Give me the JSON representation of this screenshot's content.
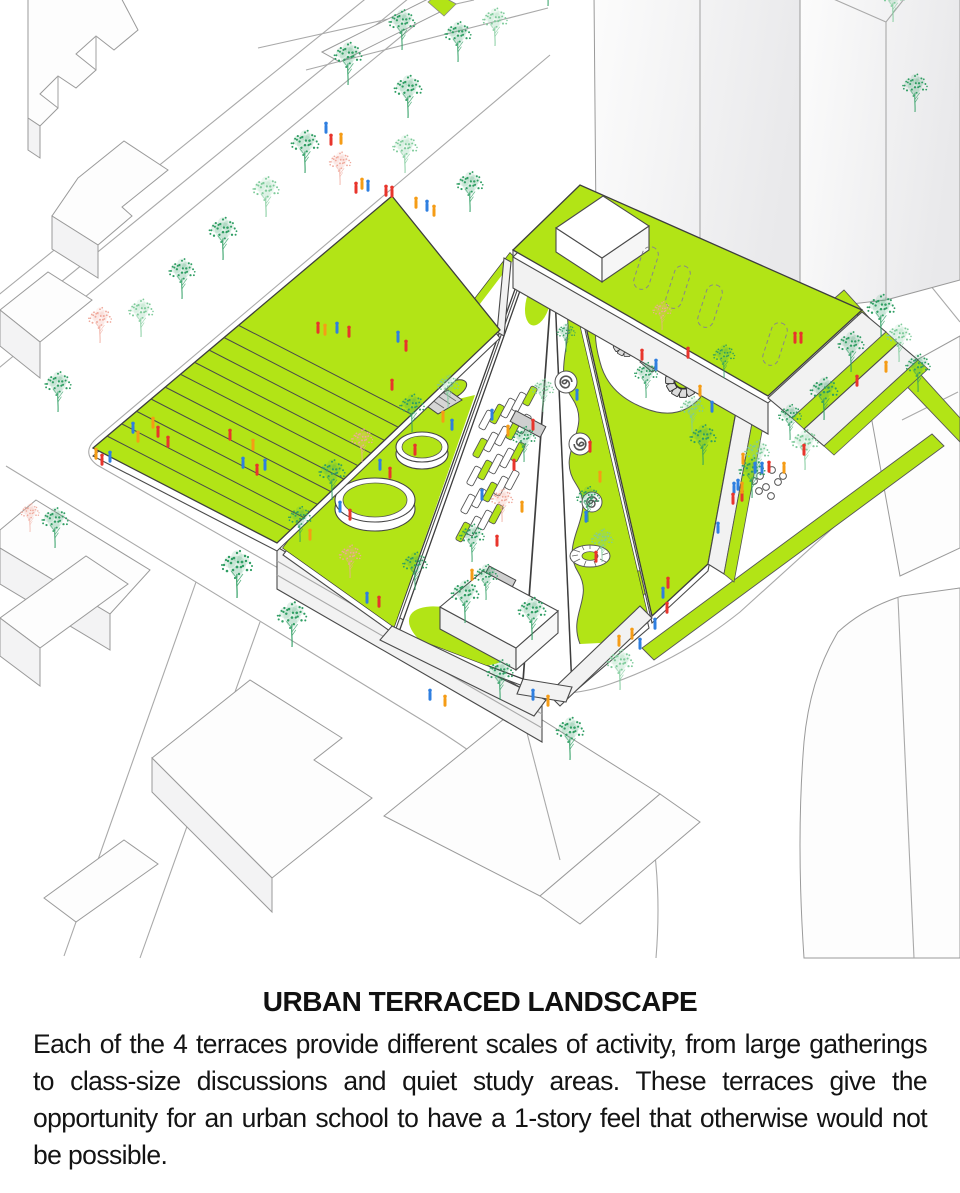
{
  "caption": {
    "title": "URBAN TERRACED LANDSCAPE",
    "body": "Each of the 4 terraces provide different scales of activity, from large gatherings to class-size discussions and quiet study areas. These terraces give the opportunity for an urban school to have a 1-story feel that otherwise would not be possible."
  },
  "palette": {
    "lawn_green": "#b2e416",
    "tree_green": "#2f9e63",
    "tree_light": "#7fcb9b",
    "tree_pink": "#efa89b",
    "person_red": "#e8352c",
    "person_blue": "#2f7fe0",
    "person_orange": "#f59c16",
    "wall_white": "#f2f2f2",
    "ramp_gray": "#d6d6d6",
    "school_outline": "#3d3d3d",
    "city_outline": "#9a9a9a",
    "street_line": "#a9a9a9",
    "text": "#141414"
  },
  "symbols": {
    "tree": "stippled-tree-icon",
    "person": "pedestrian-figure-icon",
    "flower": "circular-amphitheater-icon",
    "spiral": "spiral-path-icon",
    "skylight": "dashed-skylight-outline"
  },
  "scene": {
    "trees": [
      [
        348,
        85,
        0.9,
        "g"
      ],
      [
        305,
        173,
        0.9,
        "g"
      ],
      [
        266,
        217,
        0.85,
        "l"
      ],
      [
        223,
        260,
        0.9,
        "g"
      ],
      [
        182,
        299,
        0.85,
        "g"
      ],
      [
        141,
        337,
        0.8,
        "l"
      ],
      [
        100,
        343,
        0.75,
        "p"
      ],
      [
        58,
        412,
        0.85,
        "g"
      ],
      [
        340,
        185,
        0.7,
        "p"
      ],
      [
        402,
        50,
        0.85,
        "g"
      ],
      [
        458,
        62,
        0.85,
        "g"
      ],
      [
        408,
        118,
        0.9,
        "g"
      ],
      [
        405,
        173,
        0.8,
        "l"
      ],
      [
        470,
        212,
        0.85,
        "g"
      ],
      [
        495,
        46,
        0.8,
        "l"
      ],
      [
        548,
        6,
        0.85,
        "g"
      ],
      [
        893,
        22,
        0.8,
        "l"
      ],
      [
        915,
        112,
        0.8,
        "g"
      ],
      [
        881,
        337,
        0.9,
        "g"
      ],
      [
        899,
        362,
        0.8,
        "l"
      ],
      [
        851,
        372,
        0.85,
        "g"
      ],
      [
        824,
        420,
        0.9,
        "g"
      ],
      [
        805,
        470,
        0.85,
        "l"
      ],
      [
        918,
        392,
        0.8,
        "g"
      ],
      [
        703,
        465,
        0.85,
        "g"
      ],
      [
        757,
        478,
        0.8,
        "l"
      ],
      [
        790,
        440,
        0.75,
        "g"
      ],
      [
        752,
        498,
        0.85,
        "g"
      ],
      [
        570,
        760,
        0.9,
        "g"
      ],
      [
        532,
        640,
        0.9,
        "g"
      ],
      [
        620,
        690,
        0.85,
        "l"
      ],
      [
        237,
        598,
        1,
        "g"
      ],
      [
        292,
        647,
        0.95,
        "g"
      ],
      [
        350,
        578,
        0.7,
        "p"
      ],
      [
        465,
        623,
        0.9,
        "g"
      ],
      [
        500,
        700,
        0.85,
        "g"
      ],
      [
        415,
        590,
        0.8,
        "g"
      ],
      [
        332,
        500,
        0.85,
        "g"
      ],
      [
        362,
        462,
        0.7,
        "p"
      ],
      [
        412,
        432,
        0.8,
        "g"
      ],
      [
        300,
        542,
        0.75,
        "g"
      ],
      [
        448,
        408,
        0.7,
        "l"
      ],
      [
        472,
        562,
        0.8,
        "g"
      ],
      [
        502,
        522,
        0.7,
        "p"
      ],
      [
        524,
        462,
        0.75,
        "g"
      ],
      [
        543,
        412,
        0.7,
        "l"
      ],
      [
        486,
        600,
        0.75,
        "g"
      ],
      [
        588,
        522,
        0.75,
        "g"
      ],
      [
        602,
        562,
        0.7,
        "l"
      ],
      [
        566,
        352,
        0.6,
        "g"
      ],
      [
        646,
        398,
        0.75,
        "g"
      ],
      [
        692,
        432,
        0.75,
        "l"
      ],
      [
        662,
        330,
        0.6,
        "p"
      ],
      [
        724,
        378,
        0.7,
        "g"
      ],
      [
        55,
        548,
        0.85,
        "g"
      ],
      [
        30,
        532,
        0.6,
        "p"
      ]
    ],
    "people": [
      [
        325,
        335,
        "o"
      ],
      [
        337,
        333,
        "b"
      ],
      [
        349,
        337,
        "r"
      ],
      [
        398,
        342,
        "b"
      ],
      [
        406,
        351,
        "r"
      ],
      [
        392,
        390,
        "r"
      ],
      [
        318,
        333,
        "r"
      ],
      [
        153,
        428,
        "o"
      ],
      [
        158,
        437,
        "r"
      ],
      [
        168,
        447,
        "r"
      ],
      [
        138,
        442,
        "o"
      ],
      [
        133,
        433,
        "b"
      ],
      [
        243,
        468,
        "b"
      ],
      [
        253,
        450,
        "o"
      ],
      [
        257,
        475,
        "r"
      ],
      [
        265,
        470,
        "b"
      ],
      [
        230,
        440,
        "r"
      ],
      [
        102,
        465,
        "r"
      ],
      [
        110,
        462,
        "b"
      ],
      [
        96,
        459,
        "o"
      ],
      [
        326,
        133,
        "b"
      ],
      [
        331,
        145,
        "r"
      ],
      [
        341,
        144,
        "o"
      ],
      [
        356,
        193,
        "r"
      ],
      [
        362,
        189,
        "o"
      ],
      [
        368,
        191,
        "b"
      ],
      [
        386,
        196,
        "r"
      ],
      [
        392,
        197,
        "r"
      ],
      [
        416,
        208,
        "o"
      ],
      [
        427,
        211,
        "b"
      ],
      [
        434,
        216,
        "o"
      ],
      [
        443,
        422,
        "o"
      ],
      [
        452,
        430,
        "b"
      ],
      [
        380,
        470,
        "b"
      ],
      [
        390,
        478,
        "r"
      ],
      [
        350,
        520,
        "r"
      ],
      [
        340,
        512,
        "b"
      ],
      [
        310,
        540,
        "o"
      ],
      [
        415,
        455,
        "r"
      ],
      [
        492,
        420,
        "b"
      ],
      [
        508,
        436,
        "o"
      ],
      [
        514,
        470,
        "r"
      ],
      [
        482,
        500,
        "b"
      ],
      [
        522,
        512,
        "o"
      ],
      [
        497,
        546,
        "r"
      ],
      [
        472,
        580,
        "o"
      ],
      [
        533,
        430,
        "r"
      ],
      [
        577,
        400,
        "b"
      ],
      [
        590,
        452,
        "r"
      ],
      [
        600,
        482,
        "o"
      ],
      [
        586,
        522,
        "b"
      ],
      [
        596,
        562,
        "r"
      ],
      [
        642,
        360,
        "r"
      ],
      [
        656,
        370,
        "b"
      ],
      [
        700,
        396,
        "o"
      ],
      [
        712,
        412,
        "b"
      ],
      [
        688,
        358,
        "r"
      ],
      [
        743,
        464,
        "o"
      ],
      [
        755,
        473,
        "b"
      ],
      [
        762,
        473,
        "b"
      ],
      [
        769,
        472,
        "r"
      ],
      [
        784,
        473,
        "o"
      ],
      [
        734,
        493,
        "b"
      ],
      [
        742,
        501,
        "r"
      ],
      [
        804,
        455,
        "r"
      ],
      [
        795,
        343,
        "r"
      ],
      [
        801,
        343,
        "r"
      ],
      [
        857,
        386,
        "r"
      ],
      [
        886,
        372,
        "o"
      ],
      [
        668,
        588,
        "r"
      ],
      [
        663,
        598,
        "b"
      ],
      [
        667,
        613,
        "r"
      ],
      [
        655,
        629,
        "b"
      ],
      [
        632,
        639,
        "o"
      ],
      [
        640,
        649,
        "b"
      ],
      [
        619,
        646,
        "o"
      ],
      [
        738,
        490,
        "b"
      ],
      [
        733,
        504,
        "r"
      ],
      [
        742,
        493,
        "o"
      ],
      [
        718,
        533,
        "b"
      ],
      [
        367,
        603,
        "b"
      ],
      [
        379,
        607,
        "r"
      ],
      [
        430,
        700,
        "b"
      ],
      [
        445,
        706,
        "o"
      ],
      [
        533,
        700,
        "b"
      ],
      [
        548,
        706,
        "o"
      ]
    ],
    "furniture": [
      [
        486,
        420,
        "w"
      ],
      [
        497,
        414,
        "g"
      ],
      [
        508,
        408,
        "w"
      ],
      [
        519,
        402,
        "w"
      ],
      [
        530,
        396,
        "g"
      ],
      [
        480,
        448,
        "g"
      ],
      [
        491,
        442,
        "w"
      ],
      [
        502,
        436,
        "w"
      ],
      [
        513,
        430,
        "g"
      ],
      [
        524,
        424,
        "w"
      ],
      [
        474,
        476,
        "w"
      ],
      [
        485,
        470,
        "g"
      ],
      [
        496,
        464,
        "w"
      ],
      [
        507,
        458,
        "w"
      ],
      [
        518,
        452,
        "g"
      ],
      [
        468,
        504,
        "w"
      ],
      [
        479,
        498,
        "w"
      ],
      [
        490,
        492,
        "g"
      ],
      [
        501,
        486,
        "w"
      ],
      [
        512,
        480,
        "w"
      ],
      [
        463,
        532,
        "g"
      ],
      [
        474,
        526,
        "w"
      ],
      [
        485,
        520,
        "w"
      ],
      [
        496,
        514,
        "g"
      ]
    ],
    "stages": [
      [
        528,
        424,
        34,
        12
      ],
      [
        500,
        578,
        30,
        11
      ]
    ],
    "skylights": [
      [
        646,
        268
      ],
      [
        678,
        287
      ],
      [
        710,
        306
      ],
      [
        775,
        344
      ]
    ],
    "plaza_dots": [
      [
        737,
        474
      ],
      [
        749,
        470
      ],
      [
        760,
        476
      ],
      [
        772,
        470
      ],
      [
        783,
        476
      ],
      [
        742,
        484
      ],
      [
        754,
        481
      ],
      [
        766,
        487
      ],
      [
        778,
        482
      ],
      [
        747,
        493
      ],
      [
        759,
        491
      ],
      [
        771,
        496
      ],
      [
        739,
        500
      ]
    ]
  }
}
